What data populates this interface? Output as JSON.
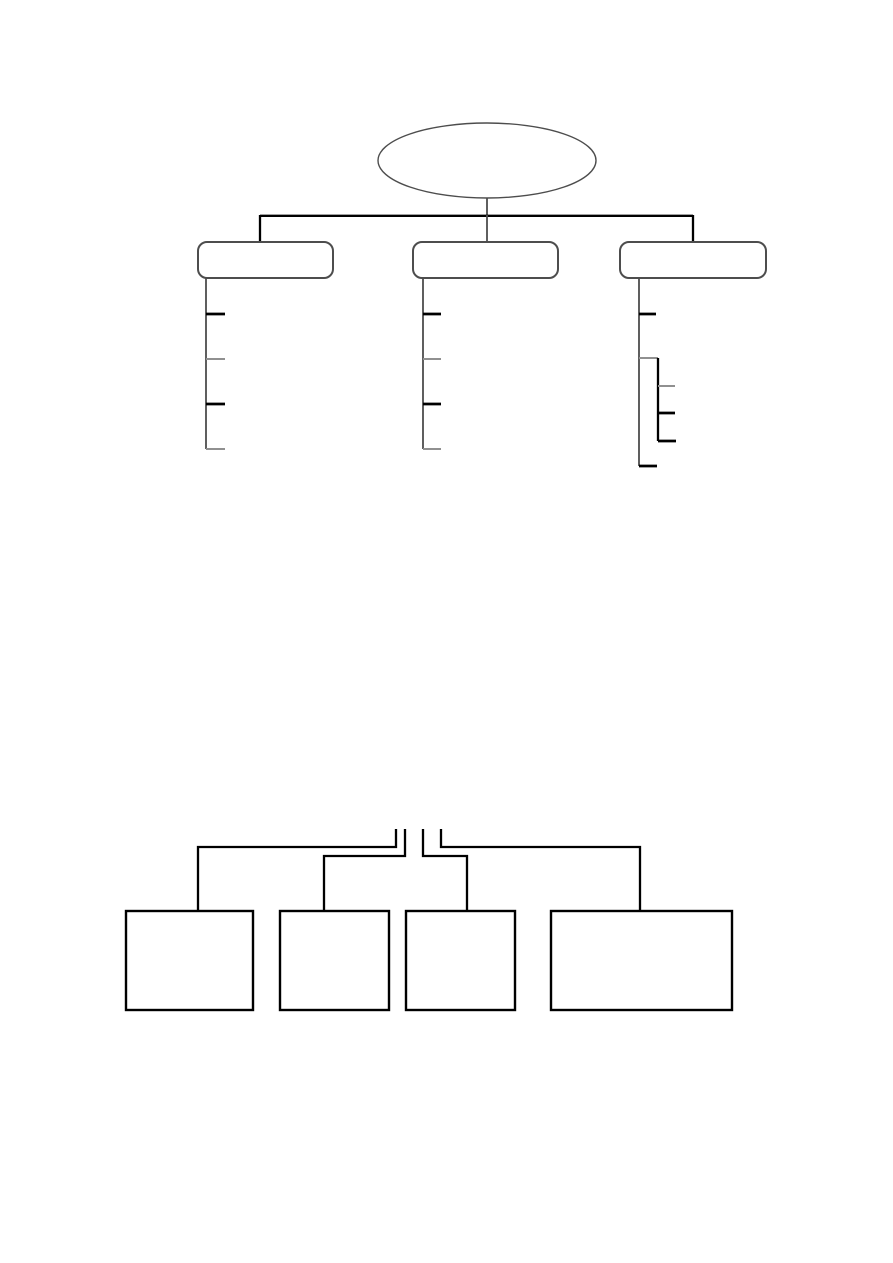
{
  "page": {
    "width": 893,
    "height": 1263,
    "background": "#ffffff",
    "visible_text": ""
  },
  "colors": {
    "line-strong": "#000000",
    "line-medium": "#4d4d4d",
    "line-soft": "#909090",
    "shape-fill": "#ffffff"
  },
  "top_diagram": {
    "type": "tree",
    "root": {
      "shape": "ellipse",
      "label": ""
    },
    "branches": [
      {
        "shape": "rounded-rectangle",
        "label": "",
        "tick_count": 4
      },
      {
        "shape": "rounded-rectangle",
        "label": "",
        "tick_count": 4
      },
      {
        "shape": "rounded-rectangle",
        "label": "",
        "tick_count": 2,
        "nested_branch_tick_count": 3
      }
    ]
  },
  "bottom_diagram": {
    "type": "block-connector",
    "box_count": 4,
    "boxes": [
      {
        "shape": "rectangle",
        "label": ""
      },
      {
        "shape": "rectangle",
        "label": ""
      },
      {
        "shape": "rectangle",
        "label": ""
      },
      {
        "shape": "rectangle",
        "label": ""
      }
    ]
  }
}
